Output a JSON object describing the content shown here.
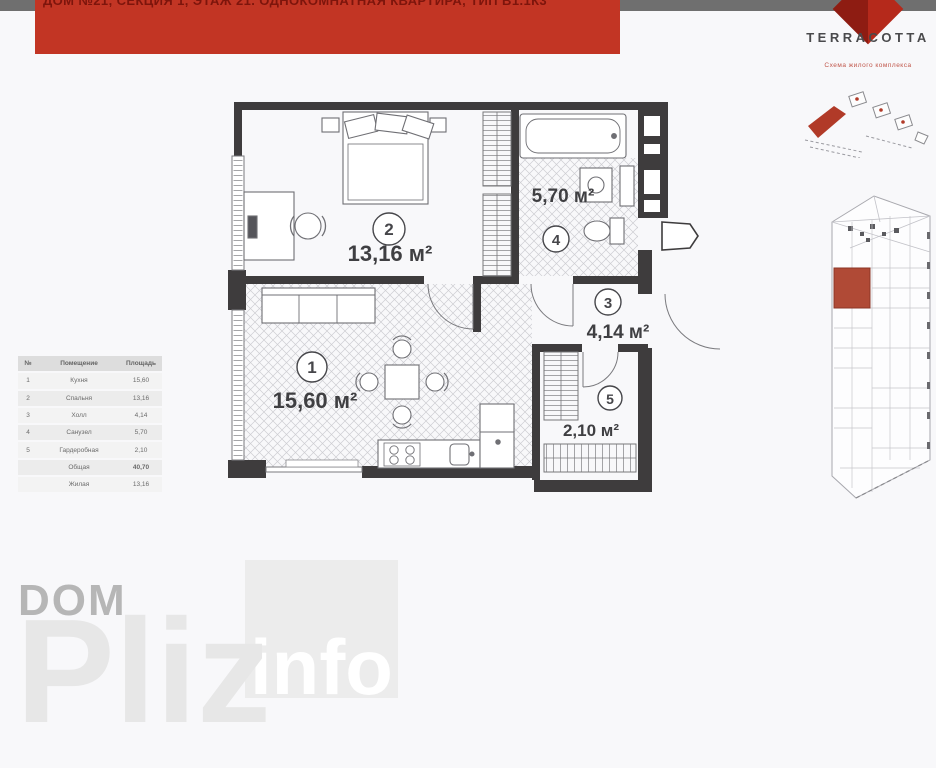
{
  "header": {
    "banner_text": "ДОМ №21, СЕКЦИЯ 1, ЭТАЖ 21. ОДНОКОМНАТНАЯ КВАРТИРА, ТИП В1.1К3"
  },
  "logo": {
    "brand": "TERRACOTTA",
    "tagline": "Схема жилого комплекса",
    "diamond_icon": "terracotta-diamond",
    "accent_color": "#b5291b"
  },
  "plan": {
    "wall_color": "#3e3c3d",
    "rooms": [
      {
        "num": "1",
        "name": "Кухня",
        "area": "15,60 м²"
      },
      {
        "num": "2",
        "name": "Спальня",
        "area": "13,16 м²"
      },
      {
        "num": "3",
        "name": "Холл",
        "area": "4,14 м²"
      },
      {
        "num": "4",
        "name": "Санузел",
        "area": "5,70 м²"
      },
      {
        "num": "5",
        "name": "Гардеробная",
        "area": "2,10 м²"
      }
    ]
  },
  "table": {
    "headers": [
      "№",
      "Помещение",
      "Площадь"
    ],
    "rows": [
      {
        "num": "1",
        "name": "Кухня",
        "area": "15,60"
      },
      {
        "num": "2",
        "name": "Спальня",
        "area": "13,16"
      },
      {
        "num": "3",
        "name": "Холл",
        "area": "4,14"
      },
      {
        "num": "4",
        "name": "Санузел",
        "area": "5,70"
      },
      {
        "num": "5",
        "name": "Гардеробная",
        "area": "2,10"
      },
      {
        "num": "",
        "name": "Общая",
        "area": "40,70"
      },
      {
        "num": "",
        "name": "Жилая",
        "area": "13,16"
      }
    ]
  },
  "watermark": {
    "dom": "DOM",
    "pliz": "Pliz",
    "info": "info"
  }
}
